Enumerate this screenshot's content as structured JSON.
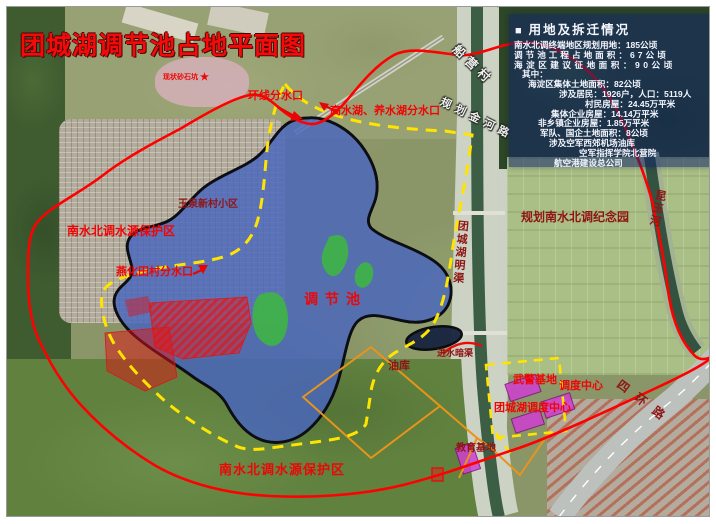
{
  "title": "团城湖调节池占地平面图",
  "legend": {
    "bullet": "■",
    "header": "用地及拆迁情况",
    "lines": [
      "南水北调终端地区规划用地：185公顷",
      "调节池工程占地面积：67公顷",
      "海淀区建议征地面积：90公顷",
      "其中：",
      "海淀区集体土地面积：82公顷",
      "涉及居民：1926户，人口：5119人",
      "村民房屋：24.45万平米",
      "集体企业房屋：14.14万平米",
      "非乡镇企业房屋：1.85万平米",
      "军队、国企土地面积：8公顷",
      "涉及空军西郊机场油库",
      "空军指挥学院北营院",
      "航空港建设总公司"
    ]
  },
  "labels": [
    {
      "text": "环线分水口"
    },
    {
      "text": "高水湖、养水湖分水口"
    },
    {
      "text": "玉泉新村小区"
    },
    {
      "text": "南水北调水源保护区"
    },
    {
      "text": "燕化田村分水口"
    },
    {
      "text": "调节池"
    },
    {
      "text": "规划南水北调纪念园"
    },
    {
      "text": "团城湖明渠"
    },
    {
      "text": "船营村"
    },
    {
      "text": "规划金河路"
    },
    {
      "text": "昆玉河"
    },
    {
      "text": "油库"
    },
    {
      "text": "进水暗渠"
    },
    {
      "text": "武警基地"
    },
    {
      "text": "调度中心"
    },
    {
      "text": "团城湖调度中心"
    },
    {
      "text": "教育基地"
    },
    {
      "text": "南水北调水源保护区"
    },
    {
      "text": "四环路"
    },
    {
      "text": "现状砂石坑"
    }
  ],
  "marker": {
    "star": "★"
  },
  "colors": {
    "site_boundary_red": "#ff0000",
    "protection_yellow": "#ffe400",
    "pool_blue": "#4866bd",
    "demolition_red": "#e01818",
    "facility_magenta": "#d03fd0",
    "parcel_orange": "#e8941a",
    "label_red": "#ee0606",
    "label_maroon": "#8f1515",
    "legend_bg": "rgba(16,36,104,0.55)"
  }
}
